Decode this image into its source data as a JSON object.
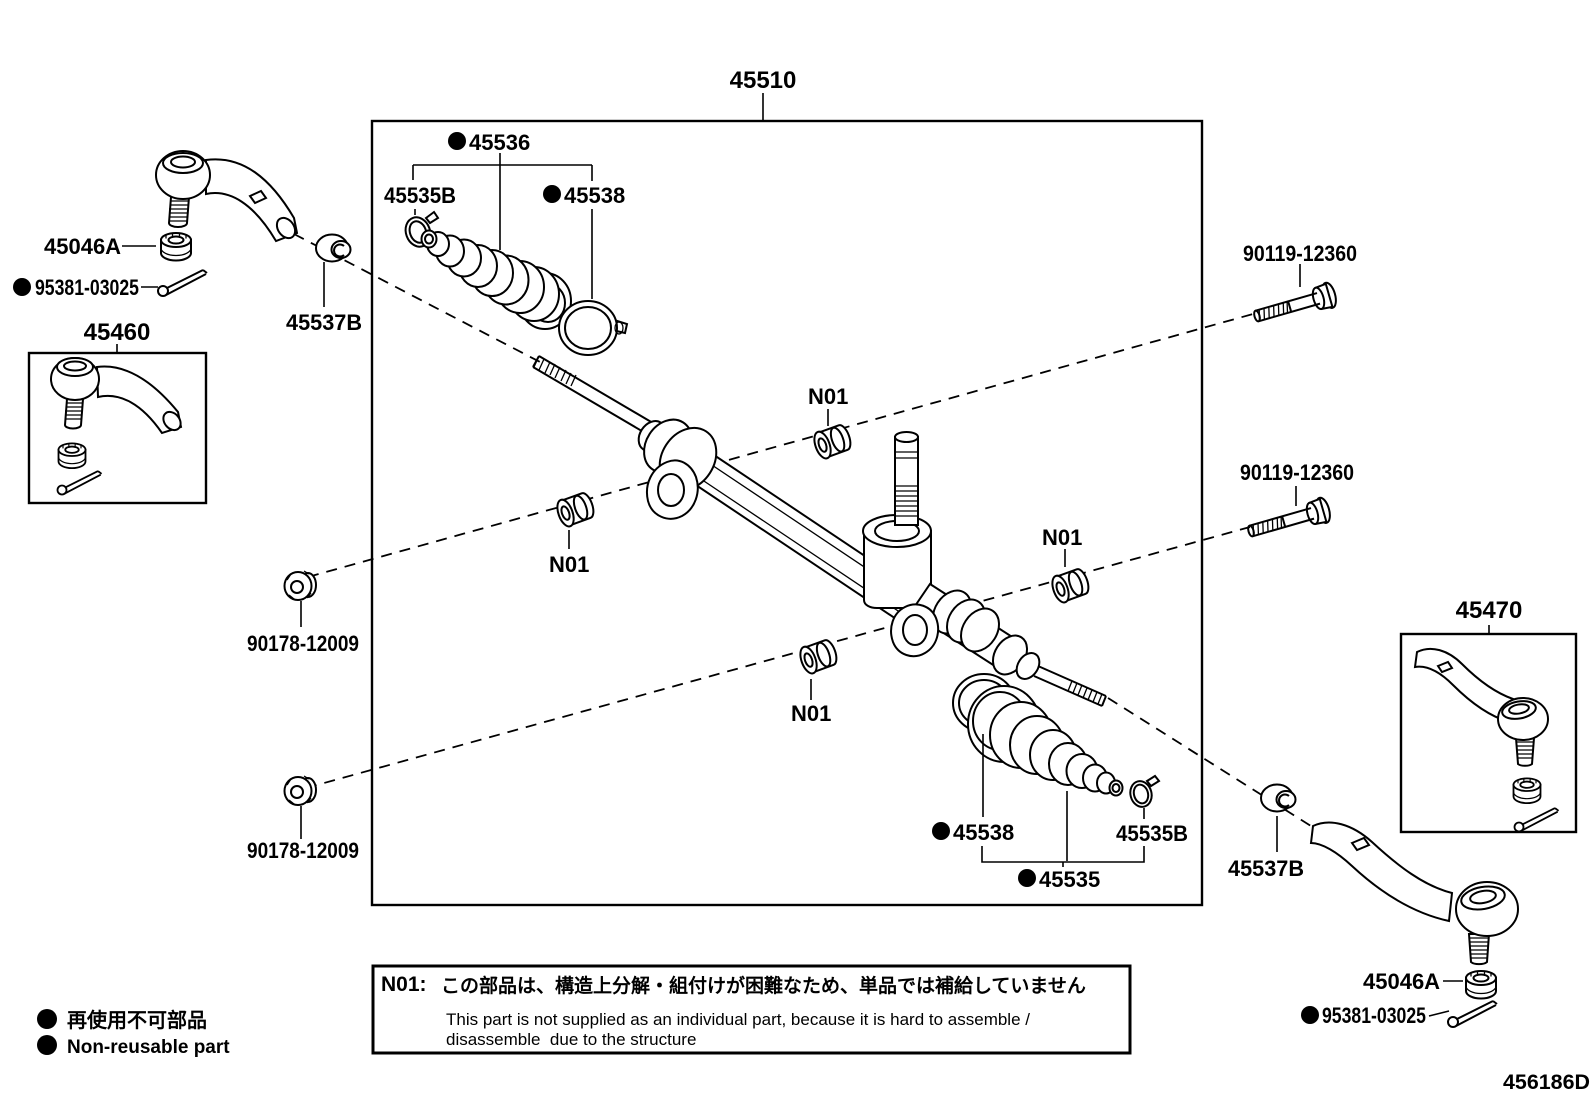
{
  "parts": {
    "p45510": "45510",
    "p45536": "45536",
    "p45535B": "45535B",
    "p45538": "45538",
    "p45535": "45535",
    "p45537B": "45537B",
    "p45046A": "45046A",
    "p95381": "95381-03025",
    "p45460": "45460",
    "p45470": "45470",
    "p90178": "90178-12009",
    "p90119": "90119-12360",
    "note_ref": "N01"
  },
  "note": {
    "ref_label": "N01:",
    "text_jp": "この部品は、構造上分解・組付けが困難なため、単品では補給していません",
    "text_en_1": "This part is not supplied as an individual part, because it is hard to assemble /",
    "text_en_2": "disassemble  due to the structure"
  },
  "legend": {
    "non_reusable_jp": "再使用不可部品",
    "non_reusable_en": "Non-reusable part"
  },
  "drawing_code": "456186D"
}
